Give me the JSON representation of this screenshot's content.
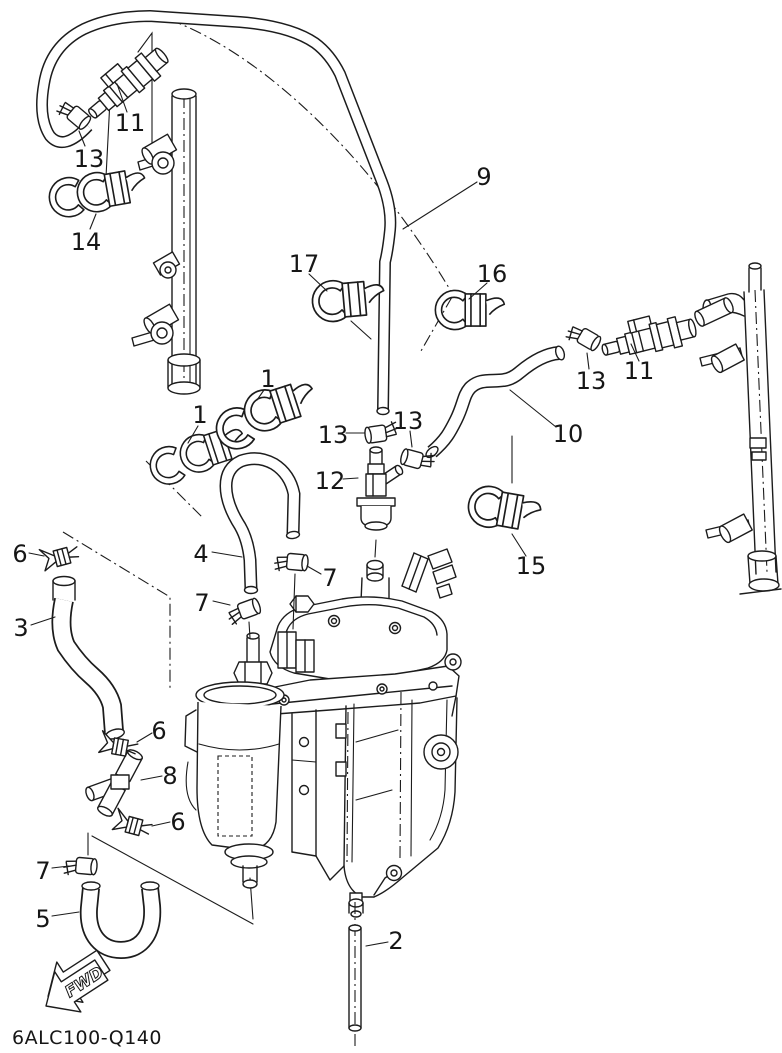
{
  "diagram": {
    "code": "6ALC100-Q140",
    "fwd_label": "FWD",
    "background": "#ffffff",
    "line_color": "#1c1c1c",
    "parts": {
      "p1": "1",
      "p2": "2",
      "p3": "3",
      "p4": "4",
      "p5": "5",
      "p6": "6",
      "p7": "7",
      "p8": "8",
      "p9": "9",
      "p10": "10",
      "p11": "11",
      "p12": "12",
      "p13": "13",
      "p14": "14",
      "p15": "15",
      "p16": "16",
      "p17": "17"
    }
  }
}
